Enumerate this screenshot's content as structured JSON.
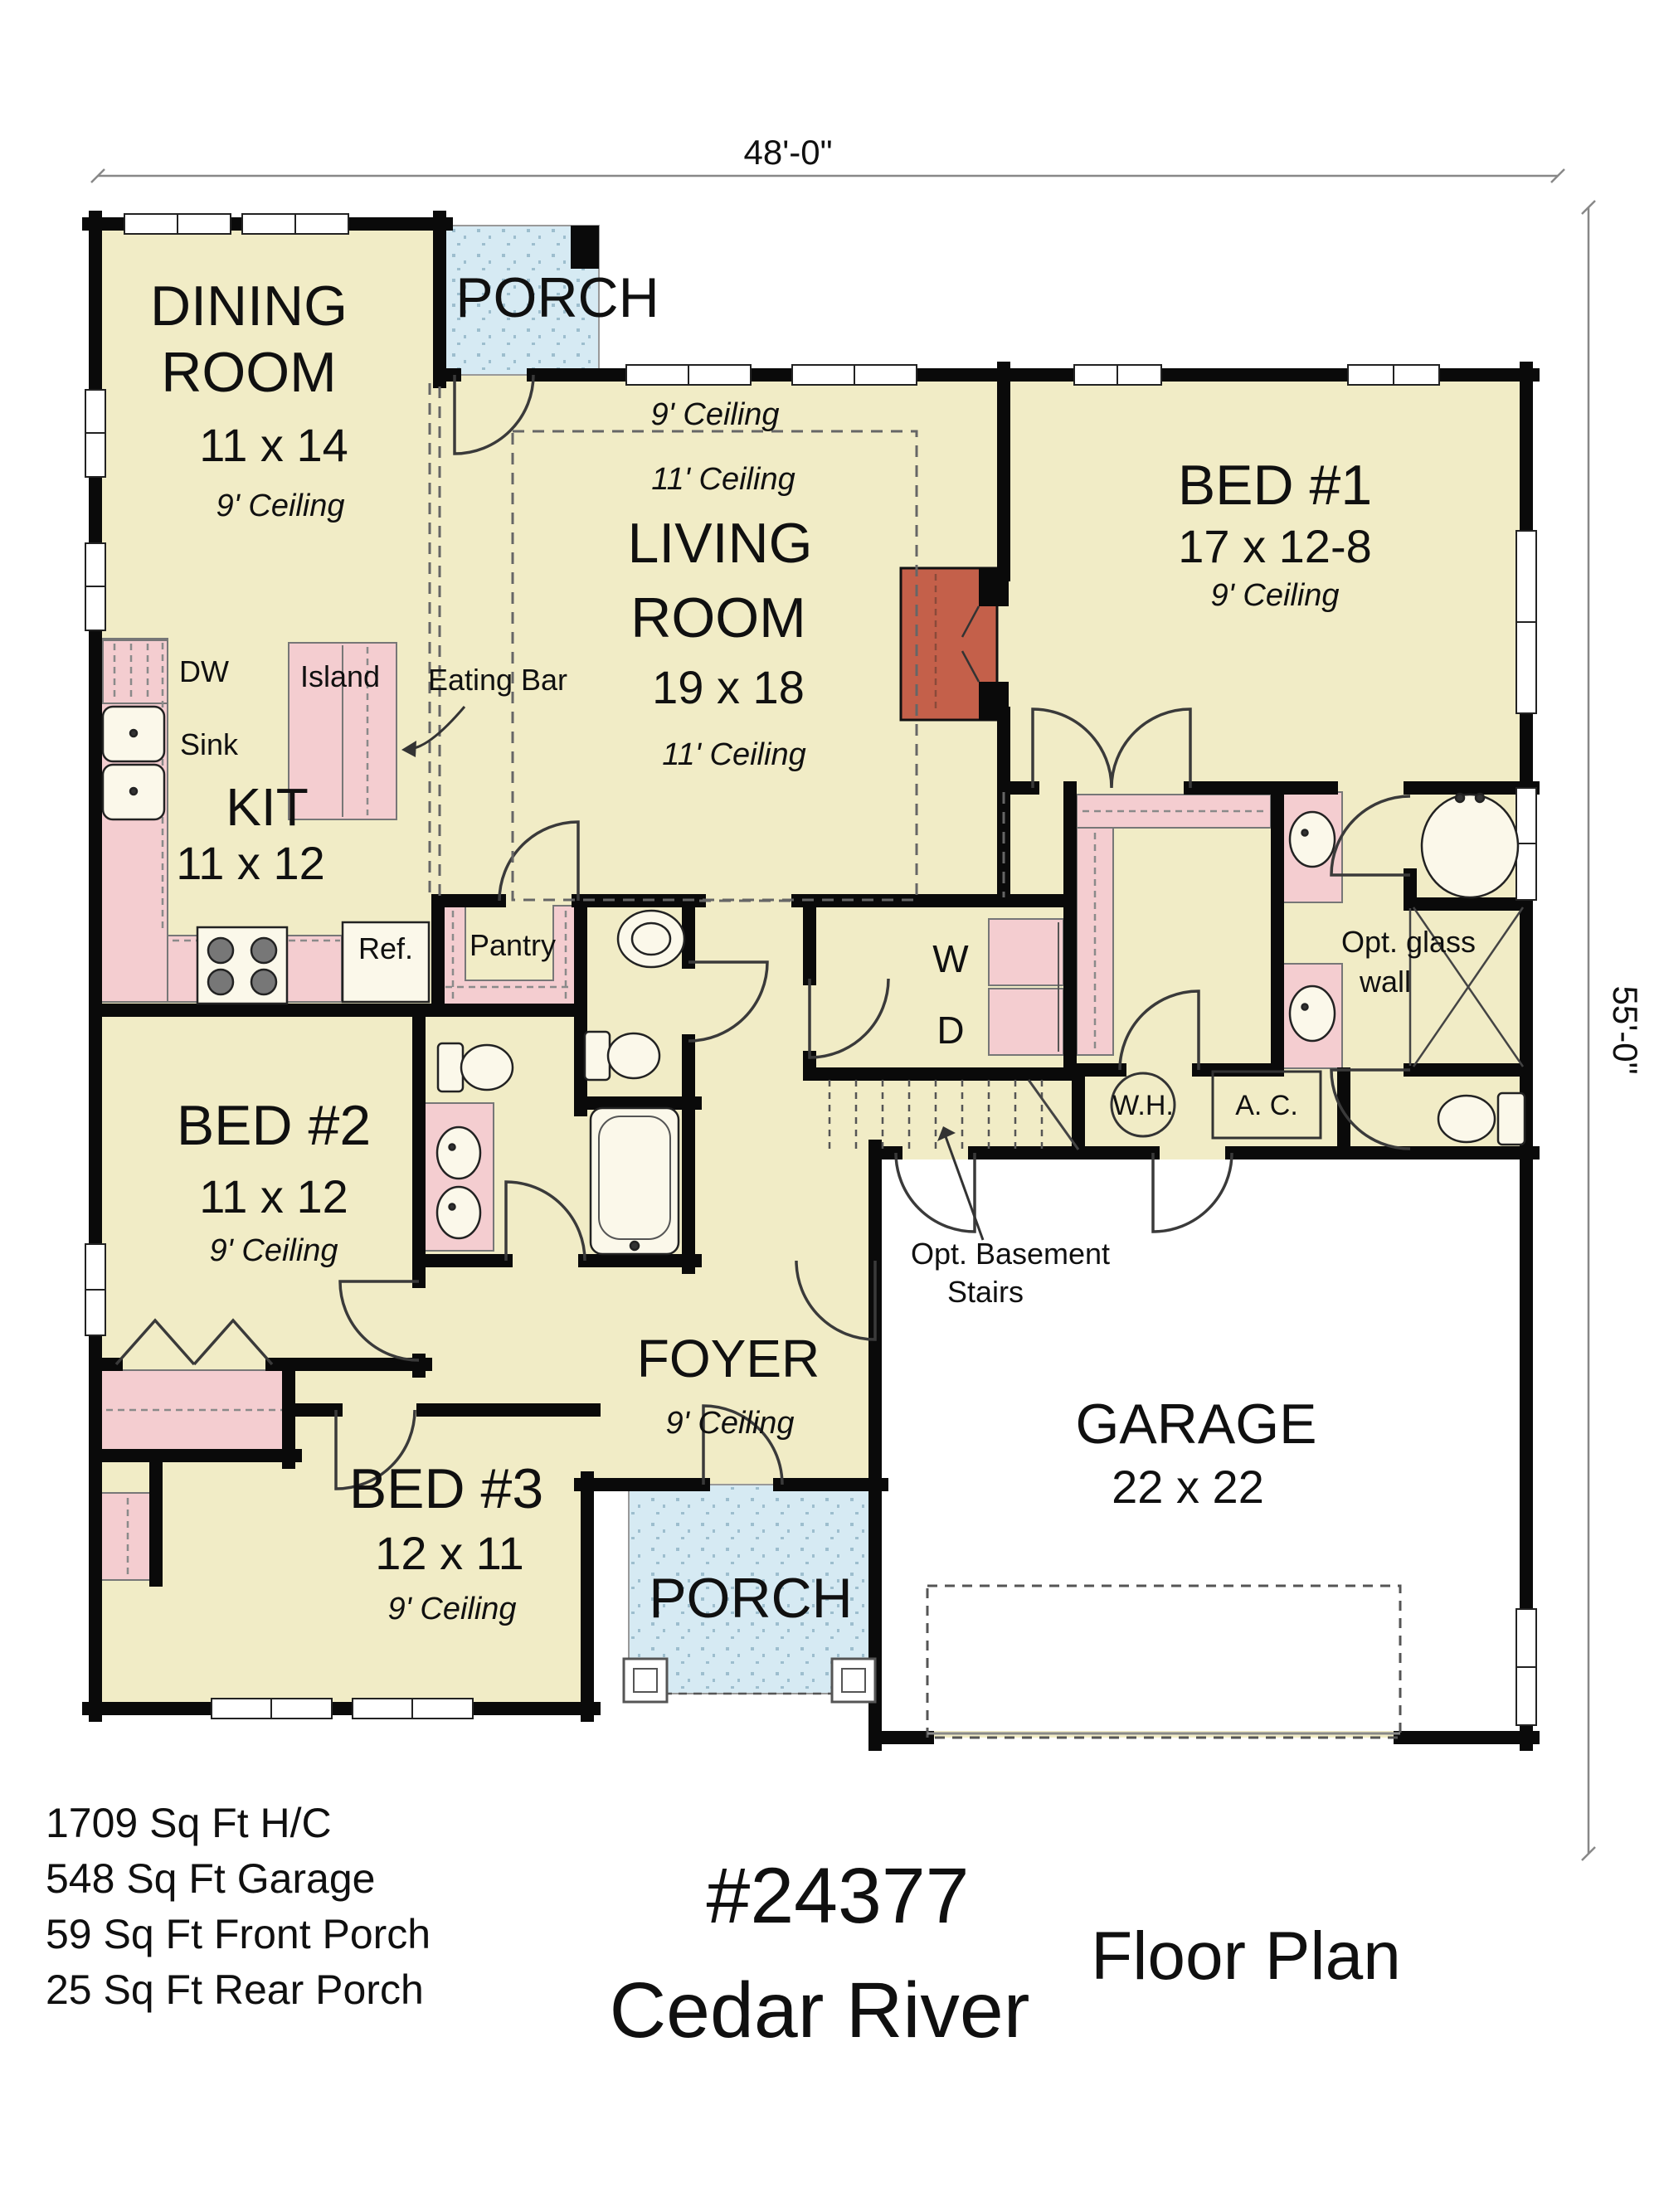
{
  "title_block": {
    "plan_number": "#24377",
    "plan_name": "Cedar River",
    "drawing_title": "Floor Plan",
    "areas": [
      "1709 Sq Ft H/C",
      "548 Sq Ft Garage",
      "59 Sq Ft Front Porch",
      "25 Sq Ft Rear Porch"
    ]
  },
  "dimensions": {
    "width": "48'-0\"",
    "depth": "55'-0\""
  },
  "rooms": {
    "dining": {
      "name_line1": "DINING",
      "name_line2": "ROOM",
      "size": "11 x 14",
      "ceiling": "9' Ceiling"
    },
    "rear_porch": {
      "name": "PORCH"
    },
    "living": {
      "name_line1": "LIVING",
      "name_line2": "ROOM",
      "size": "19 x 18",
      "ceiling_outer": "9' Ceiling",
      "ceiling_tray": "11' Ceiling",
      "ceiling_tray2": "11' Ceiling"
    },
    "bed1": {
      "name": "BED #1",
      "size": "17 x 12-8",
      "ceiling": "9' Ceiling"
    },
    "kitchen": {
      "name": "KIT",
      "size": "11 x 12"
    },
    "bed2": {
      "name": "BED #2",
      "size": "11 x 12",
      "ceiling": "9' Ceiling"
    },
    "bed3": {
      "name": "BED #3",
      "size": "12 x 11",
      "ceiling": "9' Ceiling"
    },
    "foyer": {
      "name": "FOYER",
      "ceiling": "9' Ceiling"
    },
    "garage": {
      "name": "GARAGE",
      "size": "22 x 22"
    },
    "front_porch": {
      "name": "PORCH"
    }
  },
  "fixtures": {
    "dw": "DW",
    "sink": "Sink",
    "island": "Island",
    "eating_bar": "Eating Bar",
    "ref": "Ref.",
    "pantry": "Pantry",
    "washer": "W",
    "dryer": "D",
    "water_heater": "W.H.",
    "air_conditioner": "A. C.",
    "opt_glass_line1": "Opt. glass",
    "opt_glass_line2": "wall",
    "opt_basement_line1": "Opt. Basement",
    "opt_basement_line2": "Stairs"
  },
  "colors": {
    "floor": "#F1ECC6",
    "fixture_pink": "#F4CDD0",
    "porch_blue": "#D6EAF3",
    "fireplace_red": "#C4604A",
    "wall": "#0A0A0A",
    "garage_floor": "#FFFFFF"
  }
}
